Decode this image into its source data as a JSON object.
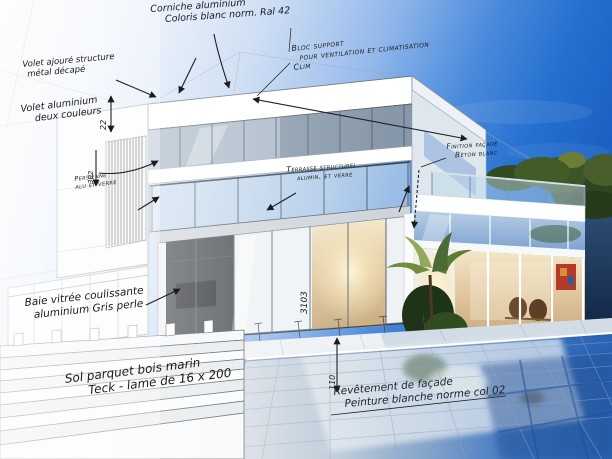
{
  "image": {
    "type": "architectural sketch blending into photorealistic villa rendering",
    "description": "Hand-annotated technical drawing of a modern two-storey villa with balcony, louvres, glass wing, stairs and swimming pool; left side is white line-art sketch, right side a realistic dusk render"
  },
  "palette": {
    "sky_left": "#f5f8fc",
    "sky_right": "#1b60c2",
    "ink": "#1c1c1c",
    "pool_deep": "#2a62b4",
    "warm_interior": "#e6d0a0",
    "foliage": "#3c5526"
  },
  "annotations": {
    "corniche": {
      "line1": "Corniche aluminium",
      "line2": "Coloris blanc norm. Ral 42"
    },
    "bloc_support": {
      "line1": "Bloc support",
      "line2": "pour ventilation et climatisation",
      "line3": "Clim"
    },
    "volet_structure": {
      "line1": "Volet ajouré structure",
      "line2": "métal décapé"
    },
    "volet_aluminium": {
      "line1": "Volet aluminium",
      "line2": "deux couleurs"
    },
    "persienne": {
      "line1": "Persienne",
      "line2": "alu et verre"
    },
    "terrasse": {
      "line1": "Terrasse structurel",
      "line2": "alumin. et verre"
    },
    "finition_facade": {
      "line1": "Finition façade",
      "line2": "Béton blanc"
    },
    "baie_vitree": {
      "line1": "Baie vitrée coulissante",
      "line2": "aluminium Gris perle"
    },
    "sol_parquet": {
      "line1": "Sol parquet bois marin",
      "line2": "Teck - lame de 16 x 200"
    },
    "revetement": {
      "line1": "Revêtement de façade",
      "line2": "Peinture blanche norme col 02"
    }
  },
  "dimensions": {
    "roof_step": "22",
    "louver_height": "302",
    "door_height": "3103",
    "pool_edge": "110"
  }
}
